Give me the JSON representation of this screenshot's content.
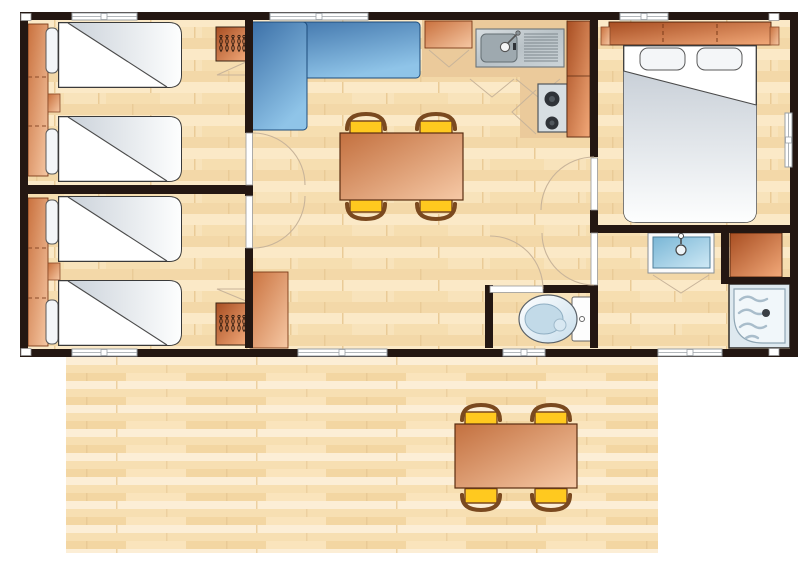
{
  "title": "Mobile-home floor plan with front wooden deck",
  "colors": {
    "wall": "#241712",
    "floor_light": "#FBE9C7",
    "floor_mid": "#F6DEB0",
    "floor_dark": "#F3D8A8",
    "deck_light": "#FCEED6",
    "deck_mid": "#F7DFB2",
    "deck_dark": "#F3D6A2",
    "counter": "#EBCA9B",
    "cabinet_dark_1": "#A84E22",
    "cabinet_dark_2": "#F2A979",
    "cabinet_light_1": "#C9713E",
    "cabinet_light_2": "#F6C8A4",
    "table_1": "#C3703F",
    "table_2": "#F6C9A6",
    "sofa_1": "#3A6EA6",
    "sofa_2": "#8FC4E8",
    "chair_seat": "#FFC91F",
    "chair_back": "#7A491F",
    "duvet_1": "#CBD2DA",
    "duvet_2": "#FDFEFE",
    "steel_1": "#D8DEE1",
    "steel_2": "#B9C2C7",
    "basin_1": "#79B6D6",
    "basin_2": "#CFE9F5",
    "shower_pan": "#DEE9EF",
    "ripple": "#A9BDCB",
    "swing": "#C8B49A",
    "window_frame": "#9AA0A6",
    "outline": "#33302C"
  },
  "building": {
    "rooms": [
      {
        "name": "twin-bedroom-top-left",
        "furniture": [
          "wardrobe-strip",
          "single-bed",
          "single-bed",
          "pillow",
          "pillow",
          "bedside-shelf",
          "hanging-wardrobe"
        ]
      },
      {
        "name": "twin-bedroom-bottom-left",
        "furniture": [
          "wardrobe-strip",
          "single-bed",
          "single-bed",
          "pillow",
          "pillow",
          "bedside-shelf",
          "hanging-wardrobe"
        ]
      },
      {
        "name": "living-dining-room",
        "furniture": [
          "corner-sofa",
          "dining-table",
          "chair",
          "chair",
          "chair",
          "chair",
          "storage-cabinet"
        ]
      },
      {
        "name": "kitchen",
        "furniture": [
          "worktop",
          "base-cabinet",
          "sink-with-drainer",
          "two-burner-hob",
          "tall-cabinet"
        ]
      },
      {
        "name": "double-bedroom",
        "furniture": [
          "double-bed",
          "headboard-storage",
          "side-table",
          "side-table"
        ]
      },
      {
        "name": "bathroom",
        "furniture": [
          "washbasin",
          "storage-cabinet",
          "shower"
        ]
      },
      {
        "name": "wc",
        "furniture": [
          "toilet"
        ]
      }
    ],
    "door_openings": 5,
    "windows": 8
  },
  "deck": {
    "name": "wooden-terrace",
    "furniture": [
      "outdoor-table",
      "chair",
      "chair",
      "chair",
      "chair"
    ]
  }
}
